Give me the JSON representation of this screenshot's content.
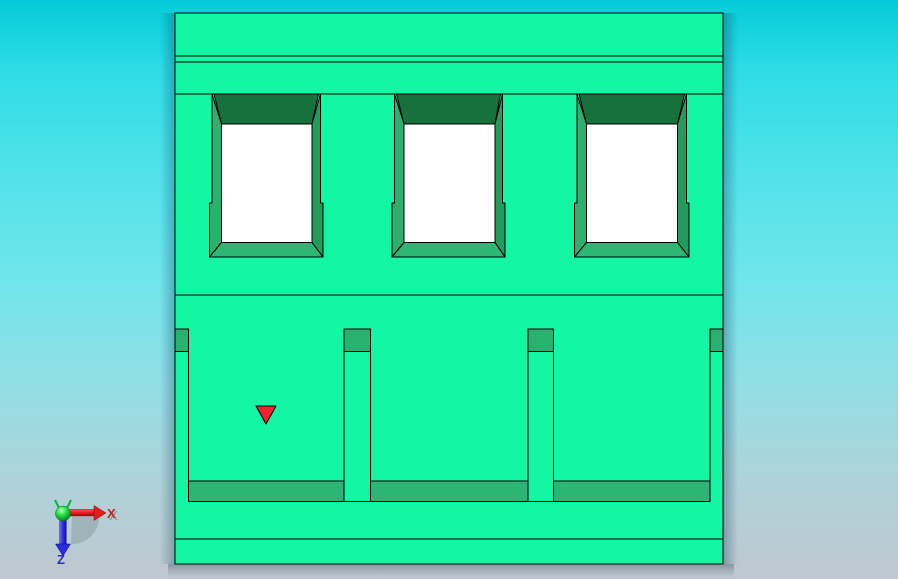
{
  "viewport": {
    "kind": "cad-3d-viewport",
    "background_top_color": "#04cbd8",
    "background_bottom_color": "#bfc7d0"
  },
  "model": {
    "face_color": "#13f6a3",
    "recess_top_color": "#16713d",
    "bevel_left_color": "#2fae6d",
    "bevel_right_color": "#219c5a",
    "bevel_bottom_color": "#2eb677",
    "slot_color": "#29b16f",
    "strip_color": "#2db575",
    "window_fill": "#ffffff",
    "edge_color": "#000000",
    "window_count": 3,
    "cavity_count": 3
  },
  "marker": {
    "shape": "triangle-down",
    "color": "#ee2230"
  },
  "triad": {
    "x_label": "X",
    "z_label": "Z",
    "x_color": "#c22520",
    "z_color": "#2a2ad0",
    "origin_color": "#00cc44",
    "shadow_color": "#8a97a0"
  }
}
